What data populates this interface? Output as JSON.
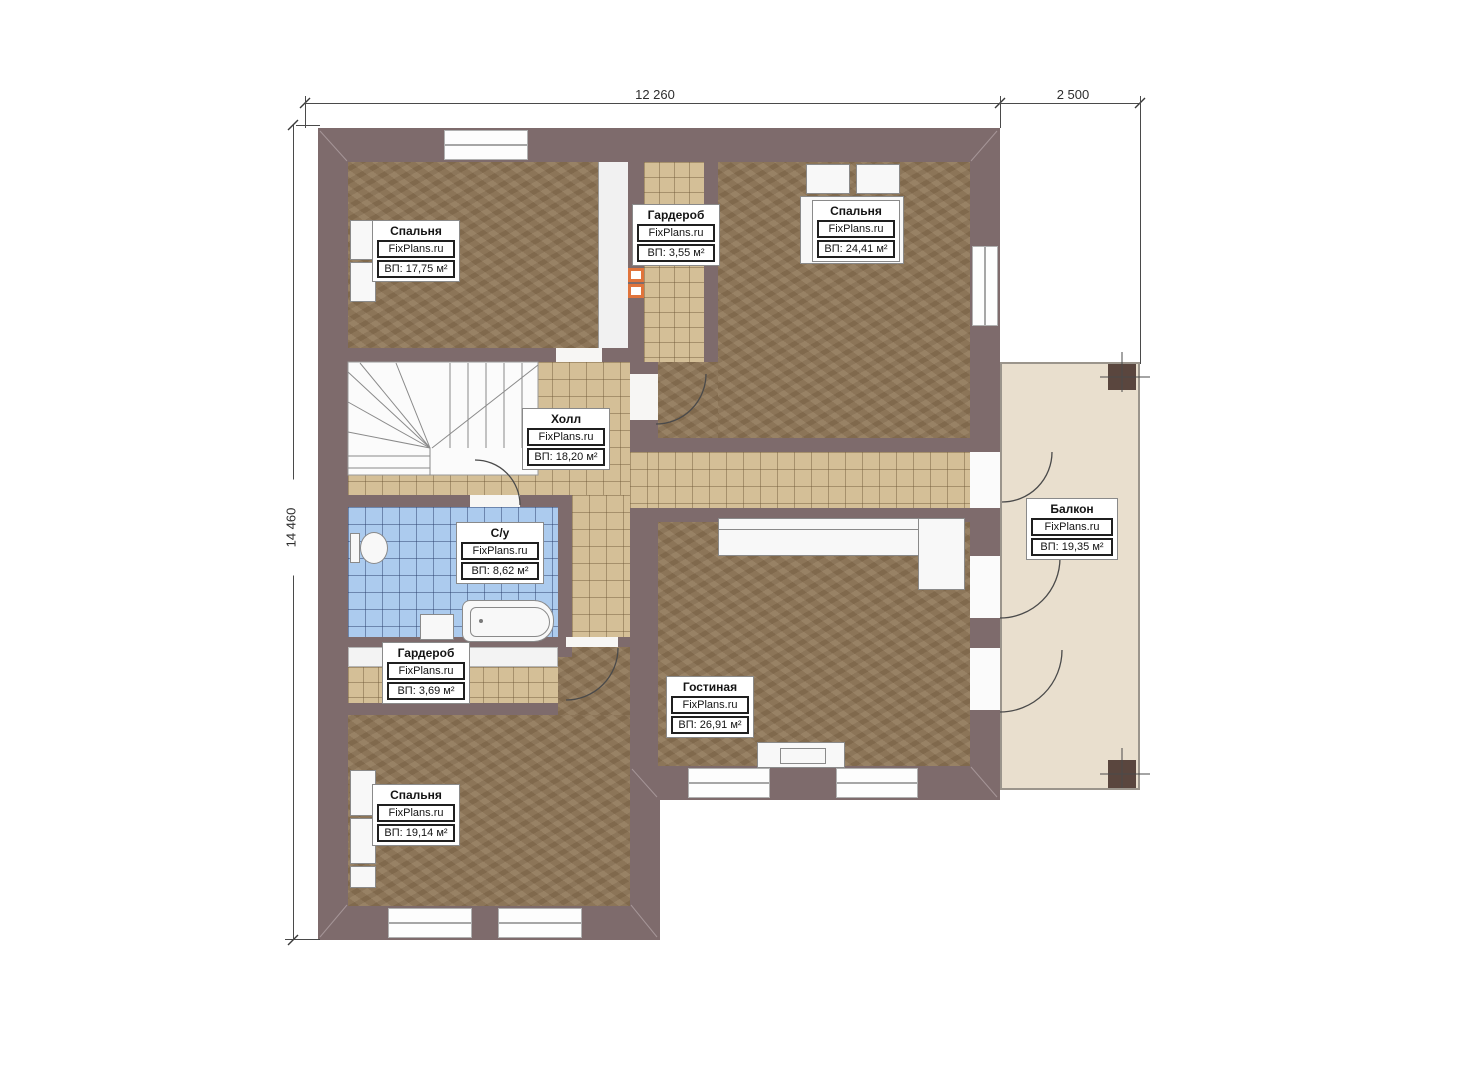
{
  "plan": {
    "brand": "FixPlans.ru",
    "dims": {
      "width_main": "12 260",
      "width_balcony": "2 500",
      "height": "14 460"
    },
    "rooms": [
      {
        "id": "bedroom-top-left",
        "name": "Спальня",
        "area": "ВП: 17,75 м²"
      },
      {
        "id": "wardrobe-top",
        "name": "Гардероб",
        "area": "ВП: 3,55 м²"
      },
      {
        "id": "bedroom-top-right",
        "name": "Спальня",
        "area": "ВП: 24,41 м²"
      },
      {
        "id": "hall",
        "name": "Холл",
        "area": "ВП: 18,20 м²"
      },
      {
        "id": "bathroom",
        "name": "С/у",
        "area": "ВП: 8,62 м²"
      },
      {
        "id": "wardrobe-bottom",
        "name": "Гардероб",
        "area": "ВП: 3,69 м²"
      },
      {
        "id": "bedroom-bottom",
        "name": "Спальня",
        "area": "ВП: 19,14 м²"
      },
      {
        "id": "living-room",
        "name": "Гостиная",
        "area": "ВП: 26,91 м²"
      },
      {
        "id": "balcony",
        "name": "Балкон",
        "area": "ВП: 19,35 м²"
      }
    ],
    "colors": {
      "wall": "#7e6b6c",
      "floor_brown": "#8d7557",
      "tile_tan": "#d4bf97",
      "tile_blue": "#accbee",
      "balcony": "#e9dfce",
      "accent_orange": "#e0743c"
    }
  }
}
